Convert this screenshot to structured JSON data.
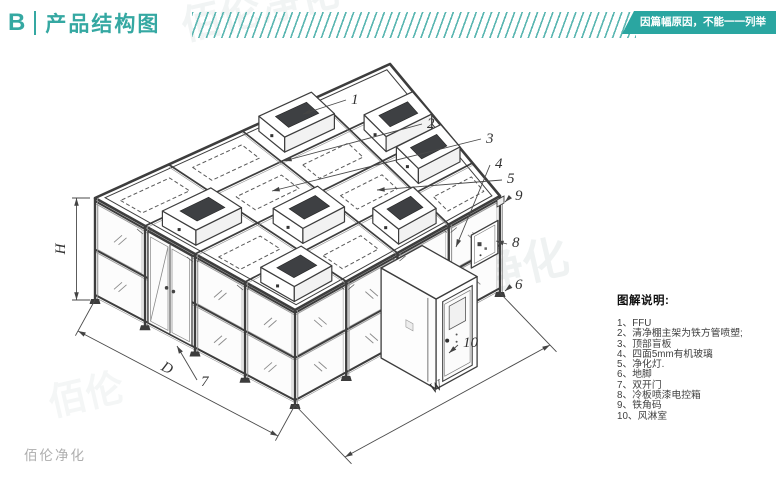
{
  "header": {
    "section_letter": "B",
    "title": "产品结构图",
    "badge": "因篇幅原因，不能一一列举"
  },
  "colors": {
    "accent": "#35a8a2",
    "badge_bg": "#2aa6a1",
    "line": "#3d3d3d",
    "leader": "#4a4a4a",
    "glass_stroke": "#b8b8b8",
    "watermark": "#9fb3b5"
  },
  "legend": {
    "title": "图解说明:",
    "items": [
      "1、FFU",
      "2、清净棚主架为铁方管喷塑;",
      "3、顶部盲板",
      "4、四面5mm有机玻璃",
      "5、净化灯.",
      "6、地脚",
      "7、双开门",
      "8、冷板喷漆电控箱",
      "9、铁角码",
      "10、风淋室"
    ]
  },
  "diagram": {
    "callouts": [
      {
        "label": "1"
      },
      {
        "label": "2"
      },
      {
        "label": "3"
      },
      {
        "label": "4"
      },
      {
        "label": "5"
      },
      {
        "label": "6"
      },
      {
        "label": "7"
      },
      {
        "label": "8"
      },
      {
        "label": "9"
      },
      {
        "label": "10"
      }
    ],
    "dimensions": {
      "height": "H",
      "depth": "D",
      "width": "W"
    }
  },
  "watermarks": [
    "佰伦净化",
    "佰伦净化",
    "佰伦"
  ],
  "footer": {
    "brand": "佰伦净化"
  }
}
